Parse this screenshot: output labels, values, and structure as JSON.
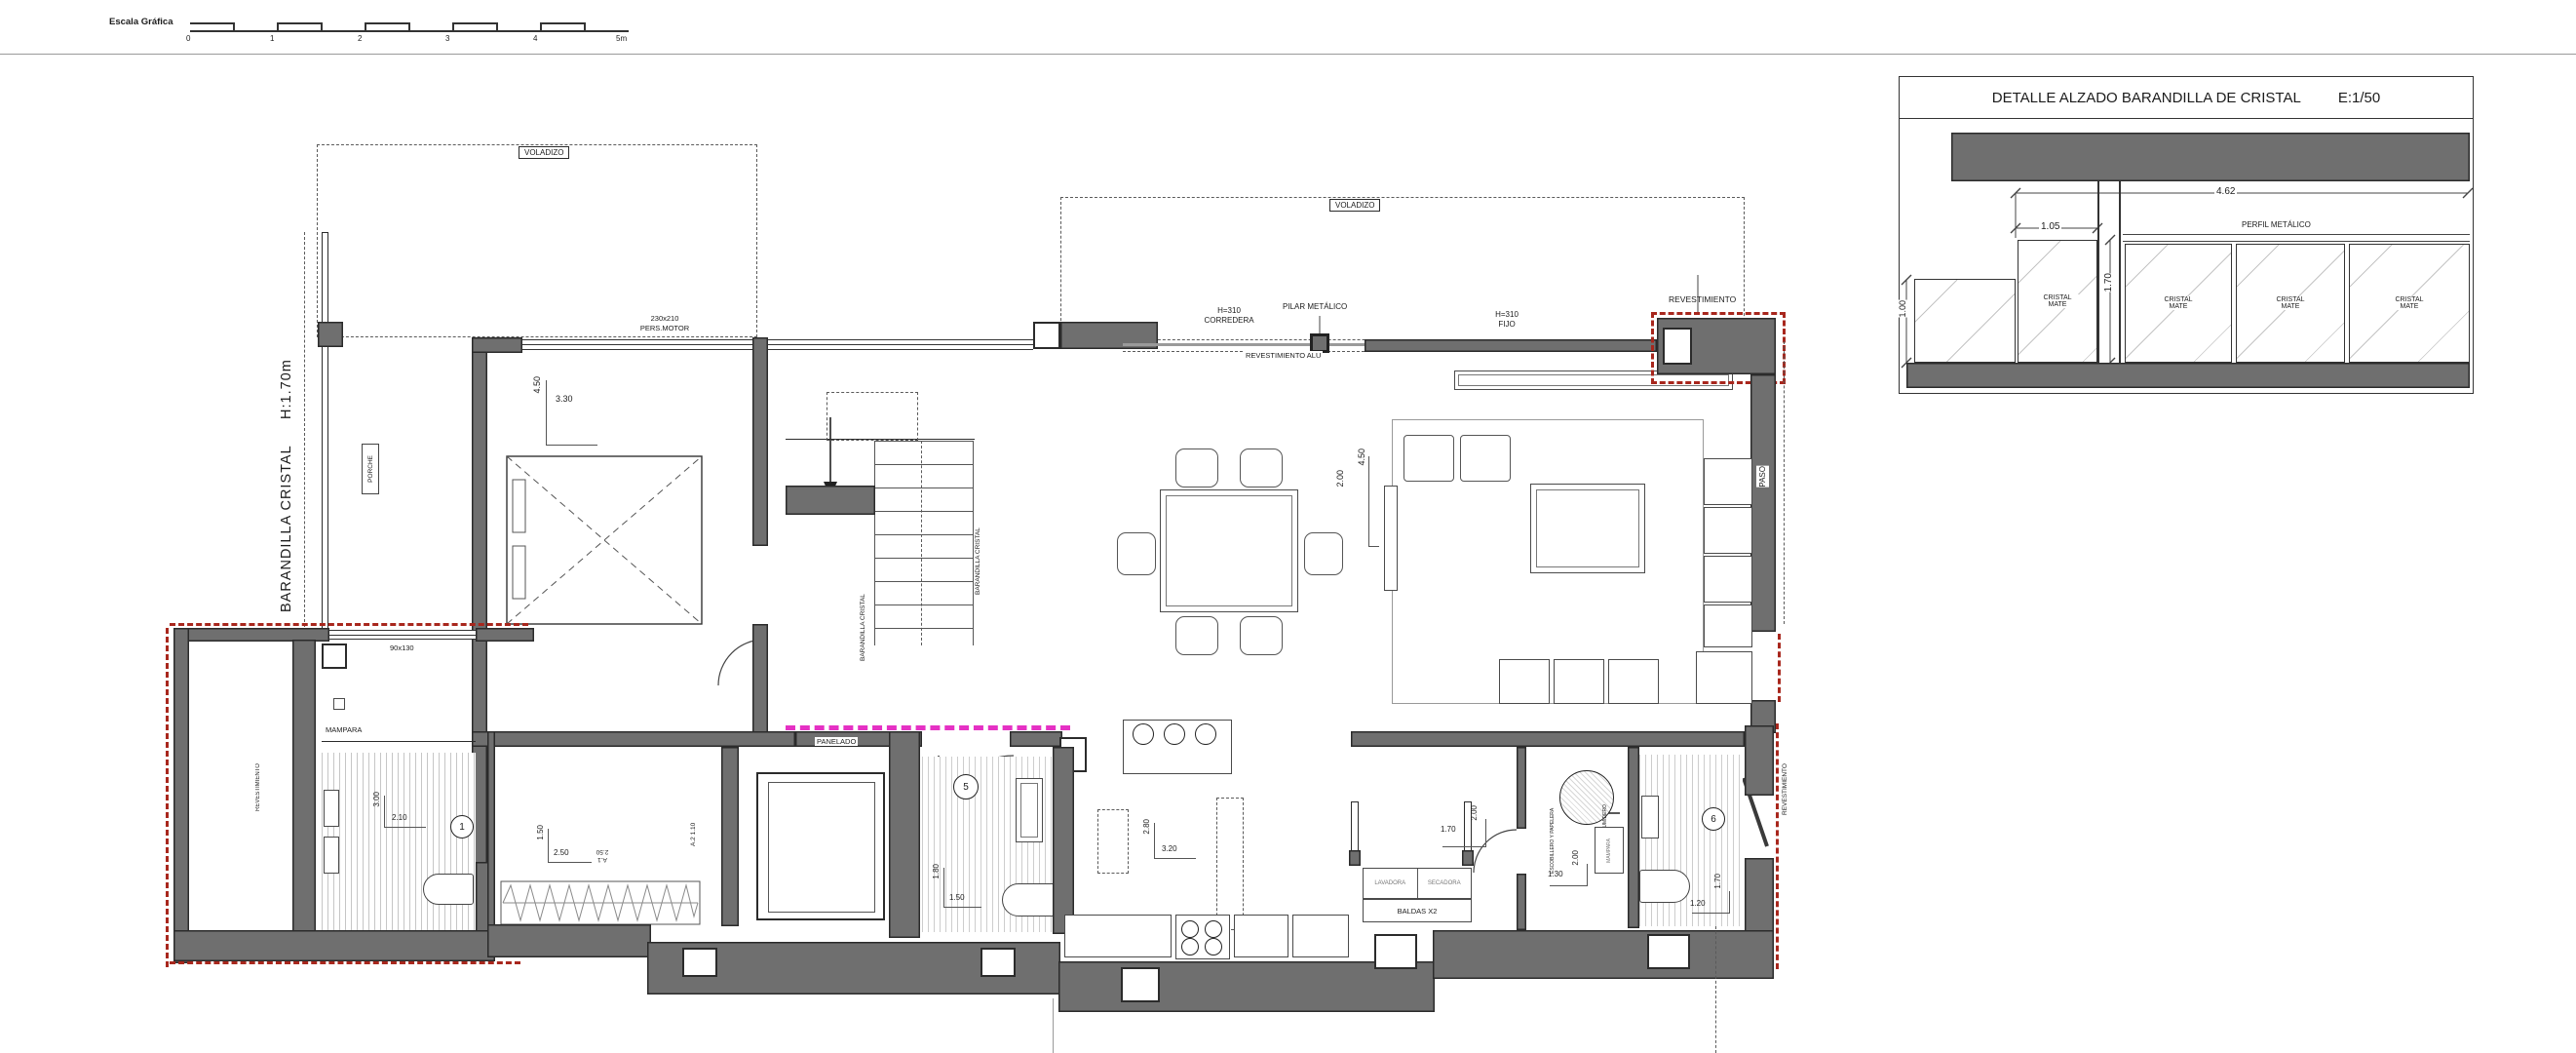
{
  "sheet": {
    "scale_label": "Escala Gráfica",
    "scale_ticks": [
      "0",
      "1",
      "2",
      "3",
      "4",
      "5m"
    ]
  },
  "detail": {
    "title": "DETALLE ALZADO BARANDILLA DE CRISTAL",
    "scale": "E:1/50",
    "dim_width_total": "4.62",
    "dim_panel": "1.05",
    "dim_height": "1.70",
    "dim_low": "1.00",
    "perfil": "PERFIL METÁLICO",
    "panels": [
      "CRISTAL MATE",
      "CRISTAL MATE",
      "CRISTAL MATE",
      "CRISTAL MATE"
    ]
  },
  "plan": {
    "voladizo": "VOLADIZO",
    "barandilla_left": "BARANDILLA CRISTAL",
    "barandilla_left_h": "H:1.70m",
    "porche": "PORCHE",
    "bedroom": {
      "dim_h": "4.50",
      "dim_w": "3.30",
      "window_size": "230x210",
      "window_type": "PERS.MOTOR"
    },
    "stairs_rail": "BARANDILLA CRISTAL",
    "corredera_l1": "H=310",
    "corredera_l2": "CORREDERA",
    "pilar": "PILAR METÁLICO",
    "fijo_l1": "H=310",
    "fijo_l2": "FIJO",
    "rev_alu": "REVESTIMIENTO ALU",
    "rev_top": "REVESTIMIENTO",
    "living": {
      "dim_w": "2.00",
      "dim_h": "4.50"
    },
    "paso": "PASO",
    "window_small": "90x130",
    "mampara": "MAMPARA",
    "panelado": "PANELADO",
    "bath1": {
      "num": "1",
      "dim_h": "3.00",
      "dim_w": "2.10"
    },
    "vestidor": {
      "dim_h": "1.50",
      "dim_w": "2.50",
      "tag_a1": "A.1",
      "tag_a1_dim": "2.50",
      "tag_a2": "A.2",
      "tag_a2_dim": "1.10"
    },
    "bath5": {
      "num": "5",
      "dim_h": "1.80",
      "dim_w": "1.50"
    },
    "kitchen": {
      "dim_h": "2.80",
      "dim_w": "3.20"
    },
    "laundry": {
      "washer": "LAVADORA",
      "dryer": "SECADORA",
      "shelves": "BALDAS X2",
      "dim_w": "1.70",
      "dim_h": "2.00"
    },
    "utility": {
      "dim_w": "1.30",
      "dim_h": "2.00",
      "sumidero": "SUMIDERO",
      "escobillero": "ESCOBILLERO Y PAPELERA",
      "mampara": "MAMPARA"
    },
    "bath6": {
      "num": "6",
      "dim_w": "1.20",
      "dim_h": "1.70"
    },
    "rev_left": "REVESTIMIENTO",
    "rev_right": "REVESTIMIENTO"
  },
  "colors": {
    "wall": "#6f6f6f",
    "red_dash": "#a8271d",
    "magenta": "#e531c4"
  }
}
